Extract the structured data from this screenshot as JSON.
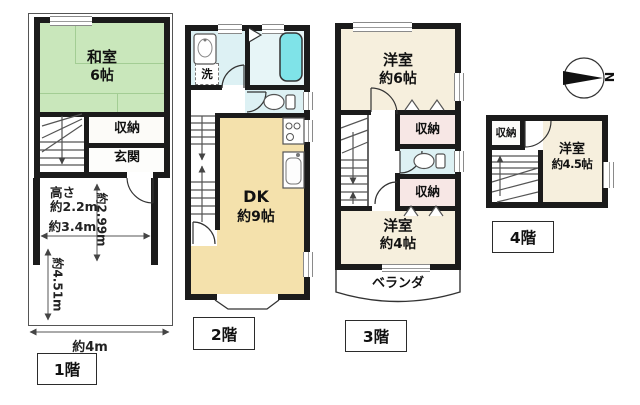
{
  "compass": {
    "north": "N"
  },
  "f1": {
    "label": "1階",
    "washitsu": "和室",
    "washitsu_size": "6帖",
    "closet": "収納",
    "entrance": "玄関",
    "dim_h1": "高さ",
    "dim_h2": "約2.2m",
    "d299": "約2.99m",
    "d34": "約3.4m",
    "d451": "約4.51m",
    "d4": "約4m"
  },
  "f2": {
    "label": "2階",
    "dk": "DK",
    "dk_size": "約9帖",
    "laundry": "洗"
  },
  "f3": {
    "label": "3階",
    "room6": "洋室",
    "room6_size": "約6帖",
    "closet_upper": "収納",
    "closet_lower": "収納",
    "room4": "洋室",
    "room4_size": "約4帖",
    "veranda": "ベランダ"
  },
  "f4": {
    "label": "4階",
    "closet": "収納",
    "room": "洋室",
    "room_size": "約4.5帖"
  }
}
